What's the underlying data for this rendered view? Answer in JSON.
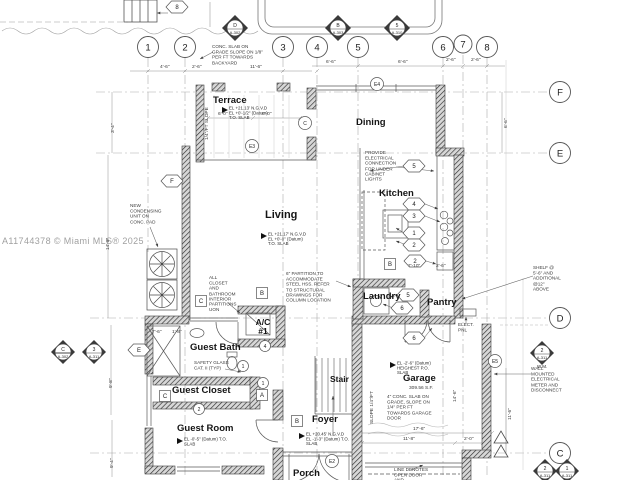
{
  "watermark": "A11744378 © Miami MLS® 2025",
  "grid": {
    "cols": [
      "1",
      "2",
      "3",
      "4",
      "5",
      "6",
      "7",
      "8"
    ],
    "rows": [
      "F",
      "E",
      "D",
      "C"
    ]
  },
  "rooms": {
    "terrace": "Terrace",
    "dining": "Dining",
    "living": "Living",
    "kitchen": "Kitchen",
    "laundry": "Laundry",
    "pantry": "Pantry",
    "ac": "A/C #1",
    "guest_bath": "Guest Bath",
    "guest_closet": "Guest Closet",
    "guest_room": "Guest Room",
    "stair": "Stair",
    "garage": "Garage",
    "garage_area": "309.56 S.F.",
    "foyer": "Foyer",
    "porch": "Porch"
  },
  "elevations": {
    "terrace": "EL +21.13' N.G.V.D  EL +0'-1/2\" (Datum)  T.O. SLAB",
    "living": "EL +21.17' N.G.V.D  EL +0'-0\" (Datum)  T.O. SLAB",
    "foyer": "EL +20.45' N.G.V.D  EL -1'-3\" (Datum)  T.O. SLAB",
    "guest_room": "EL -0'-5\" (Datum)  T.O. SLAB",
    "garage": "EL -2'-6\" (Datum)  HEIGHEST P.O. SLAB"
  },
  "notes": {
    "backyard": "CONC. SLAB ON GRADE SLOPE ON 1/8\" PER FT TOWARDS BACKYARD",
    "electrical": "PROVIDE ELECTRICAL CONNECTION FOR UNDER CABINET LIGHTS",
    "condensing": "NEW CONDENSING UNIT ON CONC. PAD",
    "closet": "ALL CLOSET AND BATHROOM INTERIOR PARTITIONS UON",
    "partition": "6\" PARTITION TO ACCOMMODATE STEEL HSS. REFER TO STRUCTURAL DRAWINGS FOR COLUMN LOCATION",
    "safety": "SAFETY GLASS CAT. II (TYP)",
    "garage_slab": "4\" CONC. SLAB ON GRADE, SLOPE ON 1/4\" PER FT TOWARDS GARAGE DOOR",
    "meter": "WALL MOUNTED ELECTRICAL METER AND DISCONNECT",
    "shelf": "SHELF @ 5'-6\" AND ADDITIONAL @12\" ABOVE",
    "door_line": "LINE DENOTES OPEN DOOR AND",
    "elect_pnl": "ELECT. PNL"
  },
  "dims": {
    "d1": "4'-6\"",
    "d2": "2'-6\"",
    "d3": "11'-6\"",
    "d4": "6'-6\"",
    "d5": "6'-6\"",
    "d6": "2'-6\"",
    "d7": "2'-6\"",
    "d8": "17'-6\"",
    "d9": "11'-8\"",
    "d10": "2'-0\"",
    "d11": "6'-0\"",
    "d12": "6'-0\"",
    "d13": "7'-6\"",
    "d14": "1'-8\"",
    "d15": "7'-10\"",
    "d16": "2'-6\"",
    "r1": "6'-6\"",
    "r2": "11'-6\"",
    "r3": "3'-4\"",
    "r4": "14'-8\"",
    "r5": "9'-8\"",
    "r6": "9'-4\"",
    "r7": "SLOPE 1/4\"/FT",
    "r8": "1/4\"/FT SLOPE",
    "r9": "14'-6\""
  },
  "tags": {
    "hex8": "8",
    "hexF": "F",
    "hexE": "E",
    "hex5": "5",
    "k4": "4",
    "k3": "3",
    "k1": "1",
    "k2": "2",
    "k2b": "2",
    "l5": "5",
    "l6": "6",
    "p6": "6",
    "cE4": "E4",
    "cE3": "E3",
    "cC": "C",
    "cE5": "E5",
    "cE2": "E2",
    "c4": "4",
    "c1": "1",
    "c1b": "1",
    "c2": "2",
    "sqB1": "B",
    "sqB2": "B",
    "sqB3": "B",
    "sqC1": "C",
    "sqC2": "C",
    "sqA": "A"
  },
  "sections": {
    "s1": {
      "t": "D",
      "n": "A-302"
    },
    "s2": {
      "t": "B",
      "n": "A-303"
    },
    "s3": {
      "t": "5",
      "n": "A-310"
    },
    "s4": {
      "t": "C",
      "n": "A-302"
    },
    "s5": {
      "t": "3",
      "n": "A-311"
    },
    "s6": {
      "t": "2",
      "n": "A-311"
    },
    "s7": {
      "t": "2",
      "n": "A-311"
    },
    "s8": {
      "t": "1",
      "n": "A-311"
    }
  },
  "misc": {
    "wm": "W.M."
  }
}
